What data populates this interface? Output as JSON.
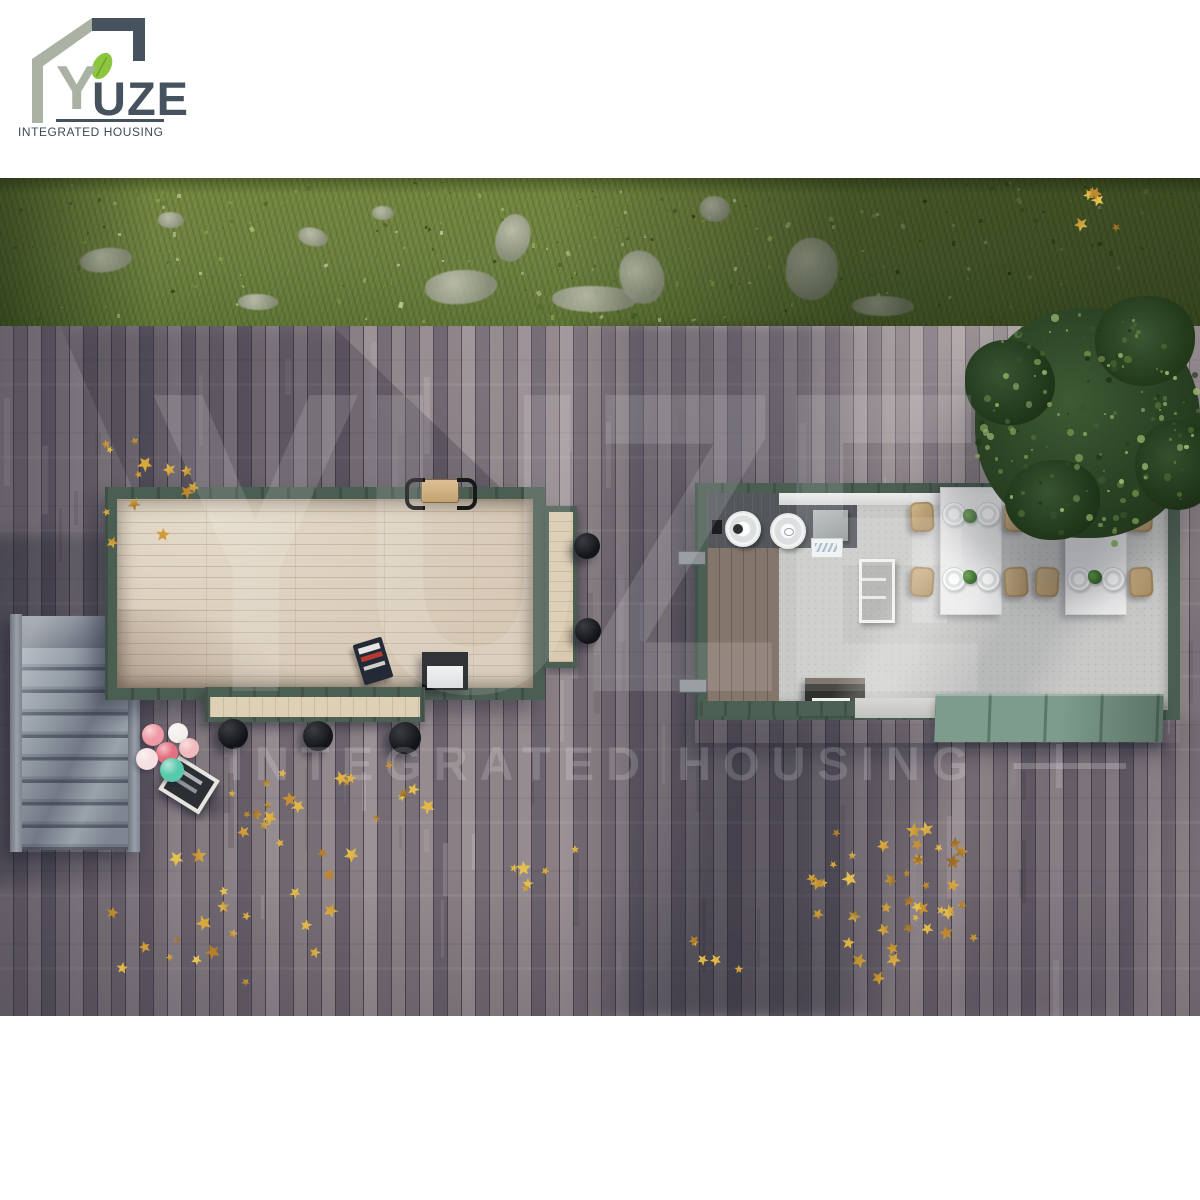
{
  "logo": {
    "brand_y": "Y",
    "brand_rest": "UZE",
    "tagline": "INTEGRATED HOUSING",
    "sage": "#a9b2a3",
    "slate": "#46525d",
    "leaf_green": "#8cc63f"
  },
  "watermark": {
    "brand": "YUZE",
    "tagline": "INTEGRATED HOUSING"
  },
  "palette": {
    "grass": "#6f823f",
    "deck": "#8b8188",
    "container_frame": "#4b5e52",
    "deck_wood_floor": "#d6c9b6",
    "cafe_floor": "#c9cac8",
    "stairs": "#99a1ab",
    "tree": "#2c4526",
    "autumn_leaf": "#dcb84a",
    "ramp": "#7d9c8b",
    "chair": "#c7ac81",
    "table": "#ededee",
    "balloons": [
      "#ef9aa6",
      "#f3efec",
      "#f0b9bd",
      "#e4707f",
      "#f5dfe0",
      "#57c9ac"
    ]
  }
}
